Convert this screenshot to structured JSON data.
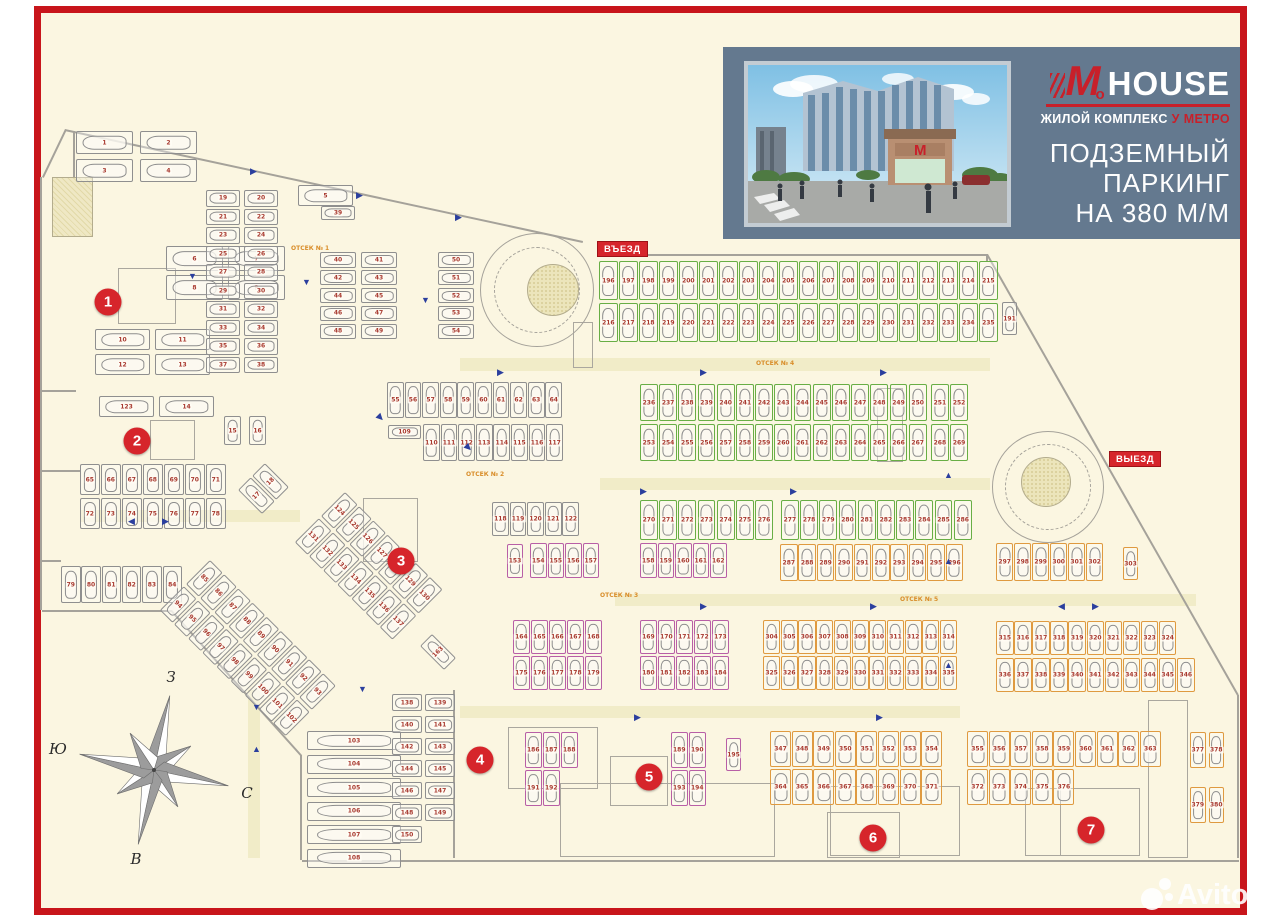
{
  "page": {
    "background": "#fbf6e1",
    "frame_color": "#c8151b",
    "margin_color": "#ffffff"
  },
  "banner": {
    "background": "#64798f",
    "accent": "#c8202a",
    "logo": {
      "m": "M",
      "o": "o",
      "house": "HOUSE",
      "tagline_white": "ЖИЛОЙ КОМПЛЕКС",
      "tagline_red": "У МЕТРО"
    },
    "title_lines": [
      "ПОДЗЕМНЫЙ",
      "ПАРКИНГ",
      "НА 380 М/М"
    ]
  },
  "plan": {
    "entrance_label": "ВЪЕЗД",
    "exit_label": "ВЫЕЗД",
    "label_bg": "#d6252b",
    "zone_color": "#d6252b",
    "number_color": "#a8392f",
    "arrow_color": "#2b3f9e",
    "spot_colors": {
      "gray": "#8f8f8f",
      "green": "#68ae45",
      "pink": "#b85fa6",
      "orange": "#df9a40"
    },
    "section_labels": [
      {
        "text": "ОТСЕК № 1",
        "x": 291,
        "y": 245
      },
      {
        "text": "ОТСЕК № 2",
        "x": 466,
        "y": 471
      },
      {
        "text": "ОТСЕК № 3",
        "x": 600,
        "y": 592
      },
      {
        "text": "ОТСЕК № 4",
        "x": 756,
        "y": 360
      },
      {
        "text": "ОТСЕК № 5",
        "x": 900,
        "y": 596
      }
    ],
    "zones": [
      {
        "label": "1",
        "x": 108,
        "y": 302
      },
      {
        "label": "2",
        "x": 137,
        "y": 441
      },
      {
        "label": "3",
        "x": 401,
        "y": 561
      },
      {
        "label": "4",
        "x": 480,
        "y": 760
      },
      {
        "label": "5",
        "x": 649,
        "y": 777
      },
      {
        "label": "6",
        "x": 873,
        "y": 838
      },
      {
        "label": "7",
        "x": 1091,
        "y": 830
      }
    ],
    "banks": [
      {
        "x": 76,
        "y": 131,
        "cols": 2,
        "rows": 2,
        "w": 57,
        "h": 23,
        "gx": 7,
        "gy": 5,
        "o": "h",
        "c": "gray",
        "n": "1-4"
      },
      {
        "x": 298,
        "y": 185,
        "cols": 1,
        "rows": 1,
        "w": 55,
        "h": 21,
        "gx": 0,
        "gy": 0,
        "o": "h",
        "c": "gray",
        "n": "5"
      },
      {
        "x": 166,
        "y": 246,
        "cols": 2,
        "rows": 2,
        "w": 57,
        "h": 25,
        "gx": 5,
        "gy": 4,
        "o": "h",
        "c": "gray",
        "n": "6-9"
      },
      {
        "x": 95,
        "y": 329,
        "cols": 2,
        "rows": 2,
        "w": 55,
        "h": 21,
        "gx": 5,
        "gy": 4,
        "o": "h",
        "c": "gray",
        "n": "10-13"
      },
      {
        "x": 99,
        "y": 396,
        "cols": 2,
        "rows": 1,
        "w": 55,
        "h": 21,
        "gx": 5,
        "gy": 0,
        "o": "h",
        "c": "gray",
        "n": "123,14"
      },
      {
        "x": 206,
        "y": 190,
        "cols": 2,
        "rows": 10,
        "w": 34,
        "h": 16.5,
        "gx": 4,
        "gy": 2,
        "o": "h",
        "c": "gray",
        "n": "19-38"
      },
      {
        "x": 321,
        "y": 206,
        "cols": 1,
        "rows": 1,
        "w": 34,
        "h": 14,
        "gx": 0,
        "gy": 0,
        "o": "h",
        "c": "gray",
        "n": "39"
      },
      {
        "x": 320,
        "y": 252,
        "cols": 2,
        "rows": 5,
        "w": 36,
        "h": 15.5,
        "gx": 5,
        "gy": 2.4,
        "o": "h",
        "c": "gray",
        "n": "40-49"
      },
      {
        "x": 438,
        "y": 252,
        "cols": 1,
        "rows": 5,
        "w": 36,
        "h": 15.5,
        "gx": 0,
        "gy": 2.4,
        "o": "h",
        "c": "gray",
        "n": "50-54"
      },
      {
        "x": 224,
        "y": 416,
        "cols": 2,
        "rows": 1,
        "w": 17,
        "h": 29,
        "gx": 8,
        "gy": 0,
        "o": "v",
        "c": "gray",
        "n": "15,16"
      },
      {
        "x": 80,
        "y": 464,
        "cols": 7,
        "rows": 2,
        "w": 19.5,
        "h": 31,
        "gx": 1.5,
        "gy": 3,
        "o": "v",
        "c": "gray",
        "n": "65-78"
      },
      {
        "x": 61,
        "y": 566,
        "cols": 6,
        "rows": 1,
        "w": 19.5,
        "h": 37,
        "gx": 0.8,
        "gy": 0,
        "o": "v",
        "c": "gray",
        "n": "79-84"
      },
      {
        "x": 387,
        "y": 382,
        "cols": 10,
        "rows": 1,
        "w": 16.8,
        "h": 36,
        "gx": 0.8,
        "gy": 0,
        "o": "v",
        "c": "gray",
        "n": "55-64"
      },
      {
        "x": 388,
        "y": 425,
        "cols": 1,
        "rows": 1,
        "w": 33,
        "h": 14,
        "gx": 0,
        "gy": 0,
        "o": "h",
        "c": "gray",
        "n": "109"
      },
      {
        "x": 423,
        "y": 424,
        "cols": 8,
        "rows": 1,
        "w": 16.8,
        "h": 37,
        "gx": 0.8,
        "gy": 0,
        "o": "v",
        "c": "gray",
        "n": "110-117"
      },
      {
        "x": 492,
        "y": 502,
        "cols": 5,
        "rows": 1,
        "w": 16.8,
        "h": 34,
        "gx": 0.8,
        "gy": 0,
        "o": "v",
        "c": "gray",
        "n": "118-122"
      },
      {
        "x": 307,
        "y": 731,
        "cols": 1,
        "rows": 6,
        "w": 94,
        "h": 19,
        "gx": 0,
        "gy": 4.5,
        "o": "h",
        "c": "gray",
        "n": "103-108"
      },
      {
        "x": 392,
        "y": 694,
        "cols": 2,
        "rows": 7,
        "w": 30,
        "h": 17,
        "gx": 3,
        "gy": 5,
        "o": "h",
        "c": "gray",
        "n": "138-150"
      },
      {
        "x": 1002,
        "y": 302,
        "cols": 1,
        "rows": 1,
        "w": 15,
        "h": 33,
        "gx": 0,
        "gy": 0,
        "o": "v",
        "c": "gray",
        "n": "191"
      },
      {
        "x": 210,
        "y": 560,
        "cols": 9,
        "rows": 2,
        "w": 18,
        "h": 34,
        "gx": 2,
        "gy": 2.5,
        "o": "v",
        "c": "gray",
        "n": "85-102",
        "rot": 45
      },
      {
        "x": 345,
        "y": 492,
        "cols": 7,
        "rows": 2,
        "w": 18,
        "h": 34,
        "gx": 2,
        "gy": 2.5,
        "o": "v",
        "c": "gray",
        "n": "124-137",
        "rot": 45
      },
      {
        "x": 238,
        "y": 490,
        "cols": 2,
        "rows": 1,
        "w": 18,
        "h": 34,
        "gx": 2,
        "gy": 0,
        "o": "v",
        "c": "gray",
        "n": "17,18",
        "rot": -45
      },
      {
        "x": 420,
        "y": 646,
        "cols": 1,
        "rows": 1,
        "w": 17,
        "h": 34,
        "gx": 0,
        "gy": 0,
        "o": "v",
        "c": "gray",
        "n": "163",
        "rot": -45
      },
      {
        "x": 507,
        "y": 544,
        "cols": 1,
        "rows": 1,
        "w": 16,
        "h": 34,
        "gx": 0,
        "gy": 0,
        "o": "v",
        "c": "pink",
        "n": "153"
      },
      {
        "x": 530,
        "y": 543,
        "cols": 4,
        "rows": 1,
        "w": 16.5,
        "h": 35,
        "gx": 1,
        "gy": 0,
        "o": "v",
        "c": "pink",
        "n": "154-157"
      },
      {
        "x": 640,
        "y": 543,
        "cols": 5,
        "rows": 1,
        "w": 16.5,
        "h": 35,
        "gx": 1,
        "gy": 0,
        "o": "v",
        "c": "pink",
        "n": "158-162"
      },
      {
        "x": 513,
        "y": 620,
        "cols": 5,
        "rows": 2,
        "w": 16.8,
        "h": 34,
        "gx": 1.2,
        "gy": 2,
        "o": "v",
        "c": "pink",
        "n": "164-168,175-179"
      },
      {
        "x": 640,
        "y": 620,
        "cols": 5,
        "rows": 2,
        "w": 16.8,
        "h": 34,
        "gx": 1.2,
        "gy": 2,
        "o": "v",
        "c": "pink",
        "n": "169-173,180-184"
      },
      {
        "x": 525,
        "y": 732,
        "cols": 3,
        "rows": 2,
        "w": 16.5,
        "h": 36,
        "gx": 1.5,
        "gy": 2,
        "o": "v",
        "c": "pink",
        "n": "186,187,188,191,192"
      },
      {
        "x": 671,
        "y": 732,
        "cols": 2,
        "rows": 2,
        "w": 16.5,
        "h": 36,
        "gx": 1.5,
        "gy": 2,
        "o": "v",
        "c": "pink",
        "n": "189,190,193,194"
      },
      {
        "x": 726,
        "y": 738,
        "cols": 1,
        "rows": 1,
        "w": 15,
        "h": 33,
        "gx": 0,
        "gy": 0,
        "o": "v",
        "c": "pink",
        "n": "195"
      },
      {
        "x": 599,
        "y": 261,
        "cols": 20,
        "rows": 2,
        "w": 18.7,
        "h": 39,
        "gx": 1.3,
        "gy": 3,
        "o": "v",
        "c": "green",
        "n": "196-215,216-235"
      },
      {
        "x": 640,
        "y": 384,
        "cols": 15,
        "rows": 2,
        "w": 17.8,
        "h": 37,
        "gx": 1.4,
        "gy": 3,
        "o": "v",
        "c": "green",
        "n": "236-250,253-267"
      },
      {
        "x": 931,
        "y": 384,
        "cols": 2,
        "rows": 2,
        "w": 17.8,
        "h": 37,
        "gx": 1.4,
        "gy": 3,
        "o": "v",
        "c": "green",
        "n": "251,252,268,269"
      },
      {
        "x": 640,
        "y": 500,
        "cols": 7,
        "rows": 1,
        "w": 17.8,
        "h": 40,
        "gx": 1.4,
        "gy": 0,
        "o": "v",
        "c": "green",
        "n": "270-276"
      },
      {
        "x": 781,
        "y": 500,
        "cols": 10,
        "rows": 1,
        "w": 17.8,
        "h": 40,
        "gx": 1.4,
        "gy": 0,
        "o": "v",
        "c": "green",
        "n": "277-286"
      },
      {
        "x": 780,
        "y": 544,
        "cols": 10,
        "rows": 1,
        "w": 17.6,
        "h": 37,
        "gx": 0.8,
        "gy": 0,
        "o": "v",
        "c": "orange",
        "n": "287-296"
      },
      {
        "x": 996,
        "y": 543,
        "cols": 6,
        "rows": 1,
        "w": 17.4,
        "h": 38,
        "gx": 0.6,
        "gy": 0,
        "o": "v",
        "c": "orange",
        "n": "297-302"
      },
      {
        "x": 1123,
        "y": 547,
        "cols": 1,
        "rows": 1,
        "w": 15,
        "h": 33,
        "gx": 0,
        "gy": 0,
        "o": "v",
        "c": "orange",
        "n": "303"
      },
      {
        "x": 763,
        "y": 620,
        "cols": 11,
        "rows": 2,
        "w": 17.2,
        "h": 34,
        "gx": 0.5,
        "gy": 2,
        "o": "v",
        "c": "orange",
        "n": "304-314,325-335"
      },
      {
        "x": 996,
        "y": 621,
        "cols": 10,
        "rows": 1,
        "w": 17.6,
        "h": 34,
        "gx": 0.5,
        "gy": 0,
        "o": "v",
        "c": "orange",
        "n": "315-324"
      },
      {
        "x": 996,
        "y": 658,
        "cols": 11,
        "rows": 1,
        "w": 17.6,
        "h": 34,
        "gx": 0.5,
        "gy": 0,
        "o": "v",
        "c": "orange",
        "n": "336-346"
      },
      {
        "x": 770,
        "y": 731,
        "cols": 8,
        "rows": 2,
        "w": 21,
        "h": 36,
        "gx": 0.6,
        "gy": 2,
        "o": "v",
        "c": "orange",
        "n": "347-354,364-371"
      },
      {
        "x": 967,
        "y": 731,
        "cols": 9,
        "rows": 1,
        "w": 21,
        "h": 36,
        "gx": 0.6,
        "gy": 0,
        "o": "v",
        "c": "orange",
        "n": "355-363"
      },
      {
        "x": 967,
        "y": 769,
        "cols": 5,
        "rows": 1,
        "w": 21,
        "h": 36,
        "gx": 0.6,
        "gy": 0,
        "o": "v",
        "c": "orange",
        "n": "372-376"
      },
      {
        "x": 1190,
        "y": 732,
        "cols": 2,
        "rows": 1,
        "w": 15.5,
        "h": 36,
        "gx": 3,
        "gy": 0,
        "o": "v",
        "c": "orange",
        "n": "377,378"
      },
      {
        "x": 1190,
        "y": 787,
        "cols": 2,
        "rows": 1,
        "w": 15.5,
        "h": 36,
        "gx": 3,
        "gy": 0,
        "o": "v",
        "c": "orange",
        "n": "379,380"
      }
    ],
    "arrows": [
      {
        "x": 250,
        "y": 167,
        "d": "r"
      },
      {
        "x": 356,
        "y": 191,
        "d": "r"
      },
      {
        "x": 455,
        "y": 213,
        "d": "r"
      },
      {
        "x": 497,
        "y": 368,
        "d": "r"
      },
      {
        "x": 700,
        "y": 368,
        "d": "r"
      },
      {
        "x": 880,
        "y": 368,
        "d": "r"
      },
      {
        "x": 640,
        "y": 487,
        "d": "r"
      },
      {
        "x": 790,
        "y": 487,
        "d": "r"
      },
      {
        "x": 700,
        "y": 602,
        "d": "r"
      },
      {
        "x": 870,
        "y": 602,
        "d": "r"
      },
      {
        "x": 1092,
        "y": 602,
        "d": "r"
      },
      {
        "x": 634,
        "y": 713,
        "d": "r"
      },
      {
        "x": 876,
        "y": 713,
        "d": "r"
      },
      {
        "x": 128,
        "y": 517,
        "d": "l"
      },
      {
        "x": 162,
        "y": 517,
        "d": "r"
      },
      {
        "x": 1058,
        "y": 602,
        "d": "l"
      },
      {
        "x": 188,
        "y": 272,
        "d": "d"
      },
      {
        "x": 302,
        "y": 278,
        "d": "d"
      },
      {
        "x": 421,
        "y": 296,
        "d": "d"
      },
      {
        "x": 358,
        "y": 685,
        "d": "d"
      },
      {
        "x": 252,
        "y": 703,
        "d": "d"
      },
      {
        "x": 944,
        "y": 471,
        "d": "u"
      },
      {
        "x": 944,
        "y": 557,
        "d": "u"
      },
      {
        "x": 944,
        "y": 661,
        "d": "u"
      },
      {
        "x": 252,
        "y": 745,
        "d": "u"
      },
      {
        "x": 377,
        "y": 413,
        "d": "dr"
      },
      {
        "x": 465,
        "y": 443,
        "d": "dr"
      }
    ]
  },
  "compass": {
    "top": "З",
    "left": "Ю",
    "right": "С",
    "bottom": "В"
  },
  "watermark": {
    "text": "Avito"
  }
}
